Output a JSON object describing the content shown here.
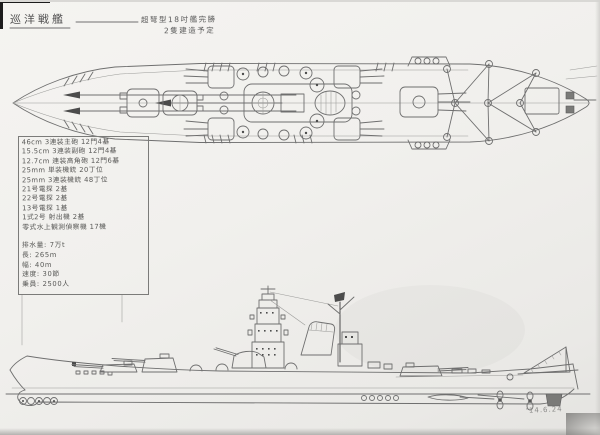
{
  "colors": {
    "paper": "#f2f1ee",
    "pencil": "#6f6f6f",
    "pencil_dark": "#4c4c4c"
  },
  "header": {
    "title": "巡洋戦艦",
    "annotation_line1": "超弩型18吋艦完勝",
    "annotation_line2": "2隻建造予定"
  },
  "spec_box": {
    "armament_lines": [
      "46cm 3連装主砲 12門4基",
      "15.5cm 3連装副砲 12門4基",
      "12.7cm 連装高角砲 12門6基",
      "25mm 単装機銃 20丁位",
      "25mm 3連装機銃 48丁位",
      "21号電探 2基",
      "22号電探 2基",
      "13号電探 1基",
      "1式2号 射出機 2基",
      "零式水上観測偵察機 17機"
    ],
    "dimension_lines": [
      "排水量: 7万t",
      "長: 265m",
      "幅: 40m",
      "速度: 30節",
      "乗員: 2500人"
    ]
  },
  "footer": {
    "date_note": "'14.6.24"
  }
}
